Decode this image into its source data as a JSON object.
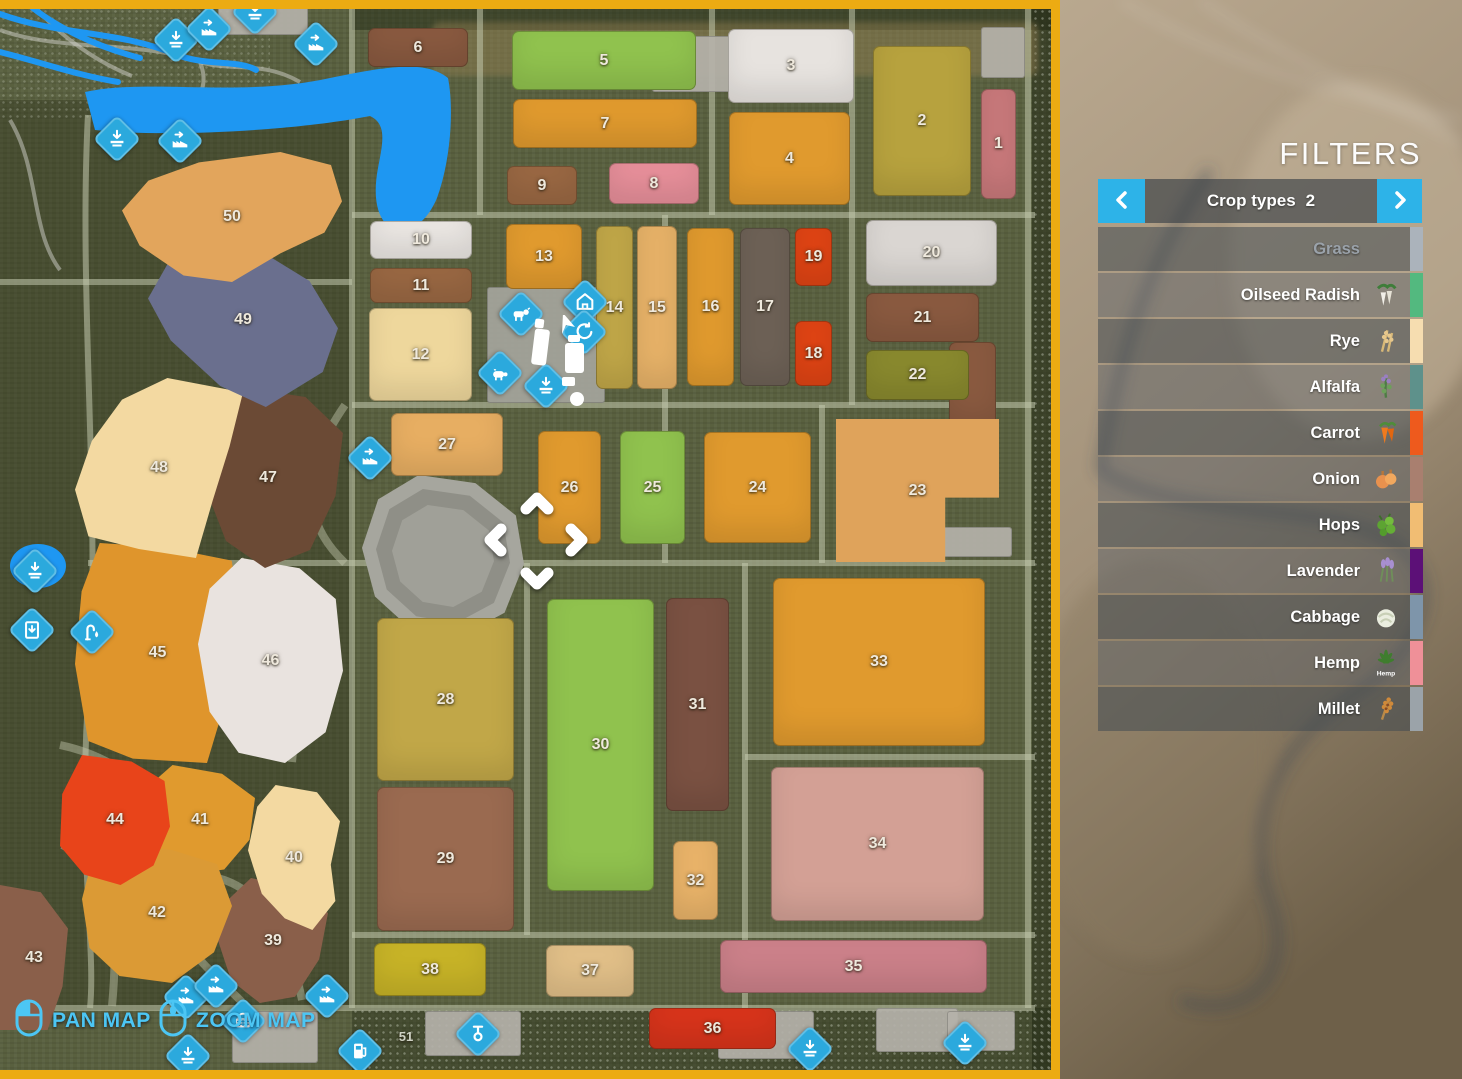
{
  "filters": {
    "title": "FILTERS",
    "header": {
      "label": "Crop types",
      "count": "2",
      "prev_icon": "chevron-left-icon",
      "next_icon": "chevron-right-icon"
    },
    "items": [
      {
        "label": "Grass",
        "strip": "#abb3bb",
        "icon": "",
        "disabled": true
      },
      {
        "label": "Oilseed Radish",
        "strip": "#53b97f",
        "icon": "oilseed-radish-icon"
      },
      {
        "label": "Rye",
        "strip": "#f6ddb0",
        "icon": "rye-icon"
      },
      {
        "label": "Alfalfa",
        "strip": "#5e918b",
        "icon": "alfalfa-icon"
      },
      {
        "label": "Carrot",
        "strip": "#ee5a1d",
        "icon": "carrot-icon"
      },
      {
        "label": "Onion",
        "strip": "#a97f6f",
        "icon": "onion-icon"
      },
      {
        "label": "Hops",
        "strip": "#f1bd73",
        "icon": "hops-icon"
      },
      {
        "label": "Lavender",
        "strip": "#5c1077",
        "icon": "lavender-icon"
      },
      {
        "label": "Cabbage",
        "strip": "#7e95aa",
        "icon": "cabbage-icon"
      },
      {
        "label": "Hemp",
        "strip": "#ef9098",
        "icon": "hemp-icon",
        "icon_text": "Hemp"
      },
      {
        "label": "Millet",
        "strip": "#9ba3a9",
        "icon": "millet-icon"
      }
    ]
  },
  "map": {
    "border_color": "#ecab12",
    "icon_color": "#2ba9dd",
    "controls": [
      {
        "label": "PAN MAP",
        "icon": "mouse-pan-icon"
      },
      {
        "label": "ZOOM MAP",
        "icon": "mouse-zoom-icon"
      }
    ],
    "fields": [
      {
        "n": "1",
        "x": 981,
        "y": 89,
        "w": 35,
        "h": 110,
        "c": "#c9797b"
      },
      {
        "n": "2",
        "x": 873,
        "y": 46,
        "w": 98,
        "h": 150,
        "c": "#b7a23e"
      },
      {
        "n": "3",
        "x": 728,
        "y": 29,
        "w": 126,
        "h": 74,
        "c": "#e7e3df"
      },
      {
        "n": "4",
        "x": 729,
        "y": 112,
        "w": 121,
        "h": 93,
        "c": "#e09a2e"
      },
      {
        "n": "5",
        "x": 512,
        "y": 31,
        "w": 184,
        "h": 59,
        "c": "#90c24e"
      },
      {
        "n": "6",
        "x": 368,
        "y": 28,
        "w": 100,
        "h": 39,
        "c": "#8a5a40"
      },
      {
        "n": "7",
        "x": 513,
        "y": 99,
        "w": 184,
        "h": 49,
        "c": "#e09a2e"
      },
      {
        "n": "8",
        "x": 609,
        "y": 163,
        "w": 90,
        "h": 41,
        "c": "#e78f9a"
      },
      {
        "n": "9",
        "x": 507,
        "y": 166,
        "w": 70,
        "h": 39,
        "c": "#9a6843"
      },
      {
        "n": "10",
        "x": 370,
        "y": 221,
        "w": 102,
        "h": 38,
        "c": "#ebe7e3"
      },
      {
        "n": "11",
        "x": 370,
        "y": 268,
        "w": 102,
        "h": 35,
        "c": "#9a6843"
      },
      {
        "n": "12",
        "x": 369,
        "y": 308,
        "w": 103,
        "h": 93,
        "c": "#eed79c"
      },
      {
        "n": "13",
        "x": 506,
        "y": 224,
        "w": 76,
        "h": 65,
        "c": "#e09a2e"
      },
      {
        "n": "14",
        "x": 596,
        "y": 226,
        "w": 37,
        "h": 163,
        "c": "#c1a748"
      },
      {
        "n": "15",
        "x": 637,
        "y": 226,
        "w": 40,
        "h": 163,
        "c": "#e7b268"
      },
      {
        "n": "16",
        "x": 687,
        "y": 228,
        "w": 47,
        "h": 158,
        "c": "#e09a2e"
      },
      {
        "n": "17",
        "x": 740,
        "y": 228,
        "w": 50,
        "h": 158,
        "c": "#6d6156"
      },
      {
        "n": "19",
        "x": 795,
        "y": 228,
        "w": 37,
        "h": 58,
        "c": "#e04414"
      },
      {
        "n": "18",
        "x": 795,
        "y": 321,
        "w": 37,
        "h": 65,
        "c": "#e04414"
      },
      {
        "n": "20",
        "x": 866,
        "y": 220,
        "w": 131,
        "h": 66,
        "c": "#dad6d2"
      },
      {
        "n": "21",
        "x": 866,
        "y": 293,
        "w": 113,
        "h": 49,
        "c": "#8a5a40"
      },
      {
        "x": 949,
        "y": 342,
        "w": 47,
        "h": 88,
        "c": "#8a5a40"
      },
      {
        "n": "22",
        "x": 866,
        "y": 350,
        "w": 103,
        "h": 50,
        "c": "#89892e"
      },
      {
        "n": "23",
        "x": 836,
        "y": 419,
        "w": 163,
        "h": 143,
        "c": "#dfa35b",
        "poly": "0% 0%,100% 0%,100% 55%,67% 55%,67% 100%,0% 100%"
      },
      {
        "n": "24",
        "x": 704,
        "y": 432,
        "w": 107,
        "h": 111,
        "c": "#e09a2e"
      },
      {
        "n": "25",
        "x": 620,
        "y": 431,
        "w": 65,
        "h": 113,
        "c": "#90c24e"
      },
      {
        "n": "26",
        "x": 538,
        "y": 431,
        "w": 63,
        "h": 113,
        "c": "#e09a2e"
      },
      {
        "n": "27",
        "x": 391,
        "y": 413,
        "w": 112,
        "h": 63,
        "c": "#e7ae62"
      },
      {
        "n": "28",
        "x": 377,
        "y": 618,
        "w": 137,
        "h": 163,
        "c": "#c1a748"
      },
      {
        "n": "29",
        "x": 377,
        "y": 787,
        "w": 137,
        "h": 144,
        "c": "#9a6a50"
      },
      {
        "n": "30",
        "x": 547,
        "y": 599,
        "w": 107,
        "h": 292,
        "c": "#90c24e"
      },
      {
        "n": "31",
        "x": 666,
        "y": 598,
        "w": 63,
        "h": 213,
        "c": "#7a5142"
      },
      {
        "n": "32",
        "x": 673,
        "y": 841,
        "w": 45,
        "h": 79,
        "c": "#e9b369"
      },
      {
        "n": "33",
        "x": 773,
        "y": 578,
        "w": 212,
        "h": 168,
        "c": "#e09a2e"
      },
      {
        "n": "34",
        "x": 771,
        "y": 767,
        "w": 213,
        "h": 154,
        "c": "#d3a095"
      },
      {
        "n": "35",
        "x": 720,
        "y": 940,
        "w": 267,
        "h": 53,
        "c": "#cb8089"
      },
      {
        "n": "36",
        "x": 649,
        "y": 1008,
        "w": 127,
        "h": 41,
        "c": "#d8341b"
      },
      {
        "n": "37",
        "x": 546,
        "y": 945,
        "w": 88,
        "h": 52,
        "c": "#e1bf88"
      },
      {
        "n": "38",
        "x": 374,
        "y": 943,
        "w": 112,
        "h": 53,
        "c": "#c7b327"
      },
      {
        "n": "39",
        "x": 218,
        "y": 878,
        "w": 110,
        "h": 125,
        "c": "#8a5f4a",
        "poly": "30% 0%,72% 8%,100% 28%,92% 65%,70% 95%,38% 100%,12% 82%,0% 50%,6% 20%"
      },
      {
        "n": "40",
        "x": 248,
        "y": 785,
        "w": 92,
        "h": 145,
        "c": "#f3d9a1",
        "poly": "30% 0%,75% 5%,100% 25%,90% 55%,95% 80%,70% 100%,40% 92%,15% 75%,0% 45%,10% 15%"
      },
      {
        "n": "41",
        "x": 145,
        "y": 765,
        "w": 110,
        "h": 110,
        "c": "#e09a2e",
        "poly": "25% 0%,70% 8%,100% 30%,95% 68%,72% 95%,35% 100%,8% 80%,0% 45%,8% 15%"
      },
      {
        "n": "42",
        "x": 82,
        "y": 843,
        "w": 150,
        "h": 140,
        "c": "#db9a35",
        "poly": "20% 0%,60% 5%,90% 15%,100% 45%,88% 78%,60% 100%,25% 95%,5% 75%,0% 40%,6% 15%"
      },
      {
        "n": "43",
        "x": 0,
        "y": 885,
        "w": 68,
        "h": 145,
        "c": "#8a5f4a",
        "poly": "0% 0%,60% 5%,100% 30%,92% 70%,70% 100%,0% 100%"
      },
      {
        "n": "44",
        "x": 60,
        "y": 755,
        "w": 110,
        "h": 130,
        "c": "#e8441a",
        "poly": "20% 0%,65% 5%,95% 20%,100% 55%,85% 85%,55% 100%,22% 92%,0% 70%,2% 30%"
      },
      {
        "n": "45",
        "x": 75,
        "y": 543,
        "w": 165,
        "h": 220,
        "c": "#df952c",
        "poly": "15% 0%,55% 2%,95% 8%,100% 35%,92% 70%,80% 100%,35% 98%,8% 90%,0% 55%,4% 22%"
      },
      {
        "n": "46",
        "x": 198,
        "y": 558,
        "w": 145,
        "h": 205,
        "c": "#e9e3df",
        "poly": "30% 0%,70% 5%,95% 20%,100% 55%,88% 85%,60% 100%,28% 95%,8% 75%,0% 42%,8% 15%"
      },
      {
        "n": "47",
        "x": 193,
        "y": 388,
        "w": 150,
        "h": 180,
        "c": "#6b4a35",
        "poly": "35% 0%,75% 5%,100% 25%,95% 60%,78% 90%,48% 100%,22% 85%,8% 55%,0% 25%,12% 8%"
      },
      {
        "n": "48",
        "x": 75,
        "y": 378,
        "w": 168,
        "h": 180,
        "c": "#f3d9a1",
        "poly": "55% 0%,100% 8%,92% 38%,82% 68%,72% 100%,38% 95%,8% 88%,0% 62%,10% 35%,28% 12%"
      },
      {
        "n": "49",
        "x": 148,
        "y": 232,
        "w": 190,
        "h": 175,
        "c": "#6a6f8e",
        "poly": "30% 0%,58% 10%,85% 28%,100% 55%,92% 80%,62% 100%,38% 88%,12% 62%,0% 38%,12% 15%"
      },
      {
        "n": "50",
        "x": 122,
        "y": 152,
        "w": 220,
        "h": 130,
        "c": "#e2a55c",
        "poly": "0% 45%,12% 22%,35% 8%,72% 0%,95% 10%,100% 38%,92% 62%,72% 78%,50% 100%,28% 95%,8% 72%"
      },
      {
        "n": "51",
        "x": 388,
        "y": 1022,
        "w": 36,
        "h": 28,
        "c": "none"
      }
    ],
    "icons": [
      {
        "type": "unload-icon",
        "x": 176,
        "y": 40
      },
      {
        "type": "production-icon",
        "x": 209,
        "y": 29
      },
      {
        "type": "unload-icon",
        "x": 255,
        "y": 12
      },
      {
        "type": "production-icon",
        "x": 316,
        "y": 44
      },
      {
        "type": "unload-icon",
        "x": 117,
        "y": 139
      },
      {
        "type": "production-icon",
        "x": 180,
        "y": 141
      },
      {
        "type": "production-icon",
        "x": 370,
        "y": 458
      },
      {
        "type": "cow-icon",
        "x": 521,
        "y": 314
      },
      {
        "type": "stable-icon",
        "x": 585,
        "y": 302
      },
      {
        "type": "recycle-icon",
        "x": 584,
        "y": 332
      },
      {
        "type": "pig-icon",
        "x": 500,
        "y": 373
      },
      {
        "type": "unload-icon",
        "x": 546,
        "y": 386
      },
      {
        "type": "unload-icon",
        "x": 35,
        "y": 571
      },
      {
        "type": "bale-icon",
        "x": 32,
        "y": 630
      },
      {
        "type": "water-icon",
        "x": 92,
        "y": 632
      },
      {
        "type": "production-icon",
        "x": 186,
        "y": 997
      },
      {
        "type": "production-icon",
        "x": 216,
        "y": 986
      },
      {
        "type": "production-icon",
        "x": 327,
        "y": 996
      },
      {
        "type": "basket-icon",
        "x": 243,
        "y": 1021
      },
      {
        "type": "unload-icon",
        "x": 188,
        "y": 1056
      },
      {
        "type": "fuel-icon",
        "x": 360,
        "y": 1051
      },
      {
        "type": "hitch-icon",
        "x": 478,
        "y": 1034
      },
      {
        "type": "unload-icon",
        "x": 810,
        "y": 1049
      },
      {
        "type": "unload-icon",
        "x": 965,
        "y": 1043
      }
    ]
  }
}
